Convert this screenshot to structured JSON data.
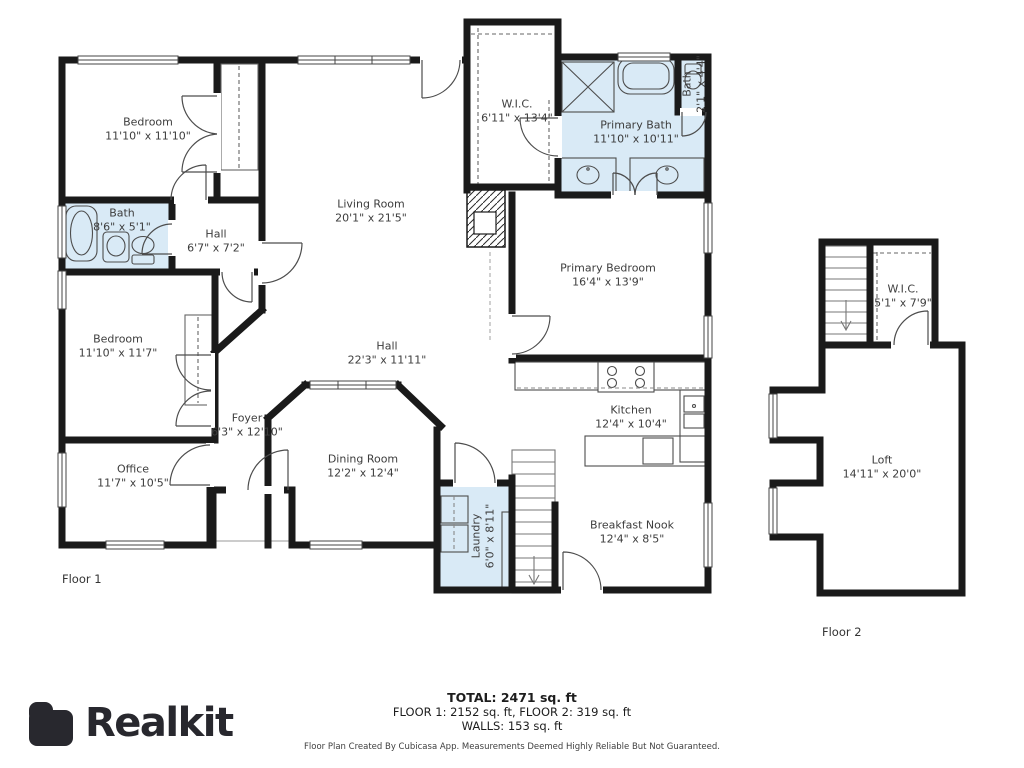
{
  "brand": {
    "name": "Realkit"
  },
  "floor1": {
    "label": "Floor 1",
    "rooms": [
      {
        "name": "Bedroom",
        "dims": "11'10\" x 11'10\""
      },
      {
        "name": "Bath",
        "dims": "8'6\" x 5'1\""
      },
      {
        "name": "Hall",
        "dims": "6'7\" x 7'2\""
      },
      {
        "name": "Bedroom",
        "dims": "11'10\" x 11'7\""
      },
      {
        "name": "Office",
        "dims": "11'7\" x 10'5\""
      },
      {
        "name": "Foyer",
        "dims": "6'3\" x 12'10\""
      },
      {
        "name": "Living Room",
        "dims": "20'1\" x 21'5\""
      },
      {
        "name": "W.I.C.",
        "dims": "6'11\" x 13'4\""
      },
      {
        "name": "Primary Bath",
        "dims": "11'10\" x 10'11\""
      },
      {
        "name": "Bath",
        "dims": "2'1\" x 4'4\""
      },
      {
        "name": "Primary Bedroom",
        "dims": "16'4\" x 13'9\""
      },
      {
        "name": "Hall",
        "dims": "22'3\" x 11'11\""
      },
      {
        "name": "Kitchen",
        "dims": "12'4\" x 10'4\""
      },
      {
        "name": "Dining Room",
        "dims": "12'2\" x 12'4\""
      },
      {
        "name": "Laundry",
        "dims": "6'0\" x 8'11\""
      },
      {
        "name": "Breakfast Nook",
        "dims": "12'4\" x 8'5\""
      }
    ]
  },
  "floor2": {
    "label": "Floor 2",
    "rooms": [
      {
        "name": "W.I.C.",
        "dims": "5'1\" x 7'9\""
      },
      {
        "name": "Loft",
        "dims": "14'11\" x 20'0\""
      }
    ]
  },
  "summary": {
    "total": "TOTAL: 2471 sq. ft",
    "floors": "FLOOR 1: 2152 sq. ft, FLOOR 2: 319 sq. ft",
    "walls": "WALLS: 153 sq. ft"
  },
  "disclaimer": "Floor Plan Created By Cubicasa App. Measurements Deemed Highly Reliable But Not Guaranteed.",
  "colors": {
    "wall": "#1a1a1a",
    "bath_fill": "#d9eaf6",
    "label_text": "#3d3d3d",
    "brand": "#28282e"
  }
}
